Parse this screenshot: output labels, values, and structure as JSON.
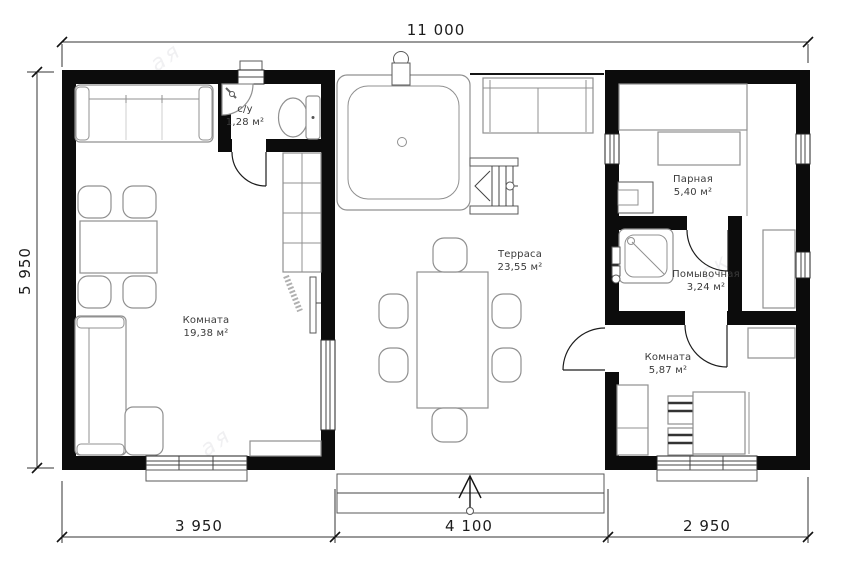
{
  "dimensions": {
    "overall_width": "11 000",
    "overall_depth": "5 950",
    "bottom_segments": [
      "3 950",
      "4 100",
      "2 950"
    ]
  },
  "rooms": [
    {
      "name": "Комната",
      "area": "19,38 м²"
    },
    {
      "name": "с/у",
      "area": "1,28 м²"
    },
    {
      "name": "Терраса",
      "area": "23,55 м²"
    },
    {
      "name": "Парная",
      "area": "5,40 м²"
    },
    {
      "name": "Помывочная",
      "area": "3,24 м²"
    },
    {
      "name": "Комната",
      "area": "5,87 м²"
    }
  ],
  "watermark_fragments": [
    "ая",
    "я в",
    "ск",
    "ая"
  ],
  "colors": {
    "walls": "#0c0c0c",
    "furniture_line": "#909090",
    "text": "#3b3b3b",
    "background": "#ffffff"
  }
}
